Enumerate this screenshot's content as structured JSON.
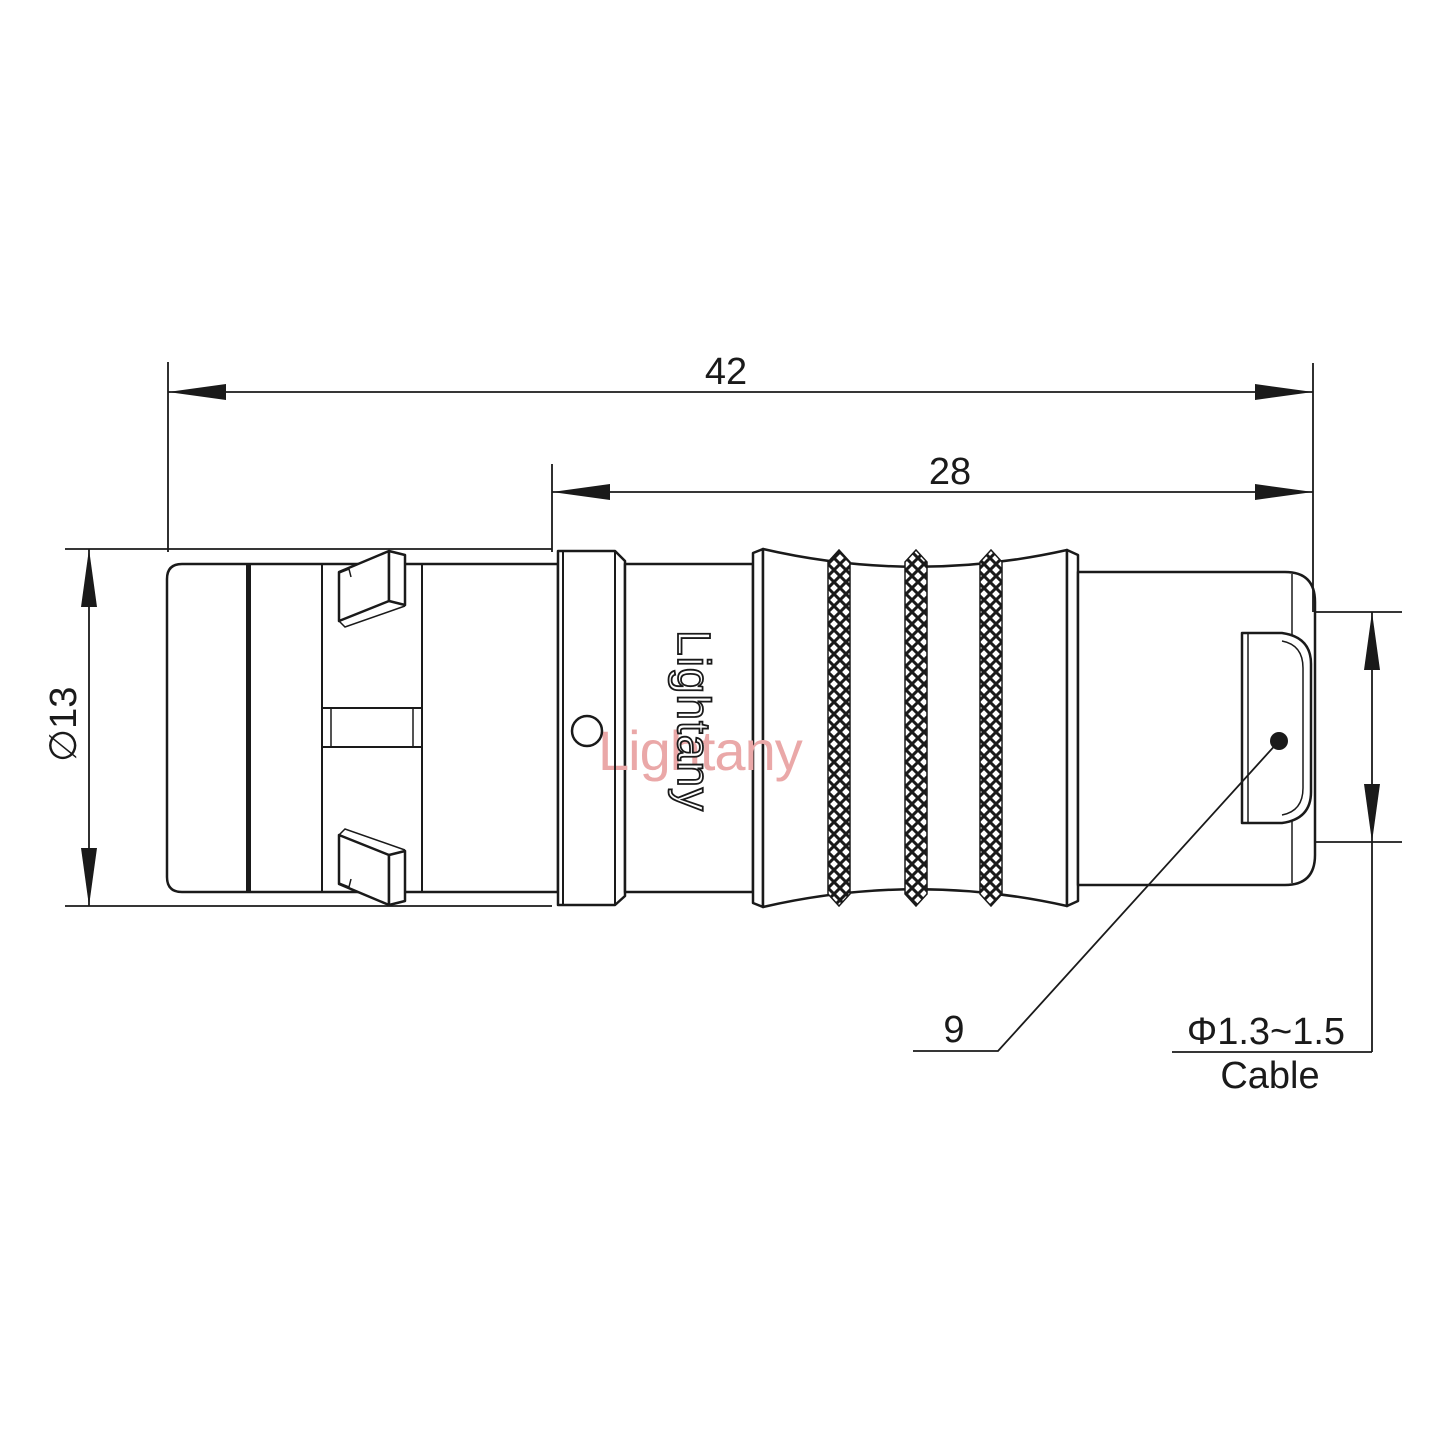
{
  "drawing": {
    "watermark": "Lightany",
    "product_marking": "Lightany",
    "dimensions": {
      "overall_length": "42",
      "rear_length": "28",
      "body_diameter": "∅13",
      "leader_size": "9",
      "cable_diameter": "Φ1.3~1.5",
      "cable_label": "Cable"
    },
    "colors": {
      "line": "#1a1a1a",
      "watermark": "#eaa8a8",
      "background": "#ffffff"
    }
  }
}
